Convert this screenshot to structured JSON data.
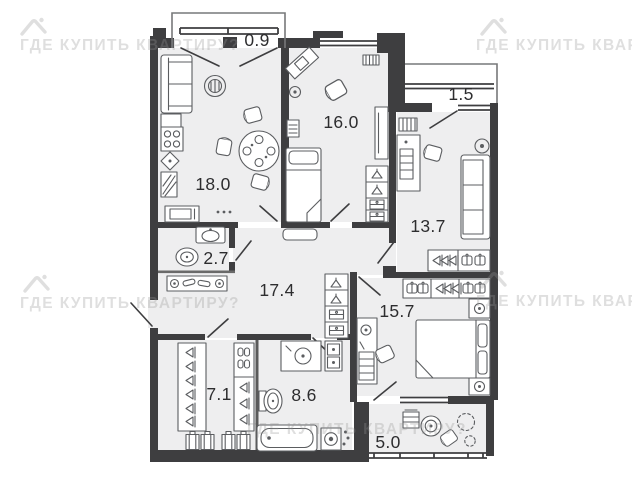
{
  "plan": {
    "rooms": [
      {
        "id": "kitchen-living",
        "area": "18.0"
      },
      {
        "id": "balcony-top-left",
        "area": "0.9"
      },
      {
        "id": "bedroom-top",
        "area": "16.0"
      },
      {
        "id": "balcony-top-right",
        "area": "1.5"
      },
      {
        "id": "room-right",
        "area": "13.7"
      },
      {
        "id": "wc-small",
        "area": "2.7"
      },
      {
        "id": "hallway",
        "area": "17.4"
      },
      {
        "id": "bedroom-right",
        "area": "15.7"
      },
      {
        "id": "wardrobe",
        "area": "7.1"
      },
      {
        "id": "bathroom",
        "area": "8.6"
      },
      {
        "id": "balcony-bottom",
        "area": "5.0"
      }
    ],
    "watermark": {
      "text": "ГДЕ КУПИТЬ КВАРТИРУ?"
    },
    "colors": {
      "wall": "#3e3e40",
      "floor": "#eeeeef",
      "furniture_stroke": "#5b5d60",
      "label": "#2d2d2f",
      "watermark": "#969696",
      "background": "#ffffff"
    }
  }
}
